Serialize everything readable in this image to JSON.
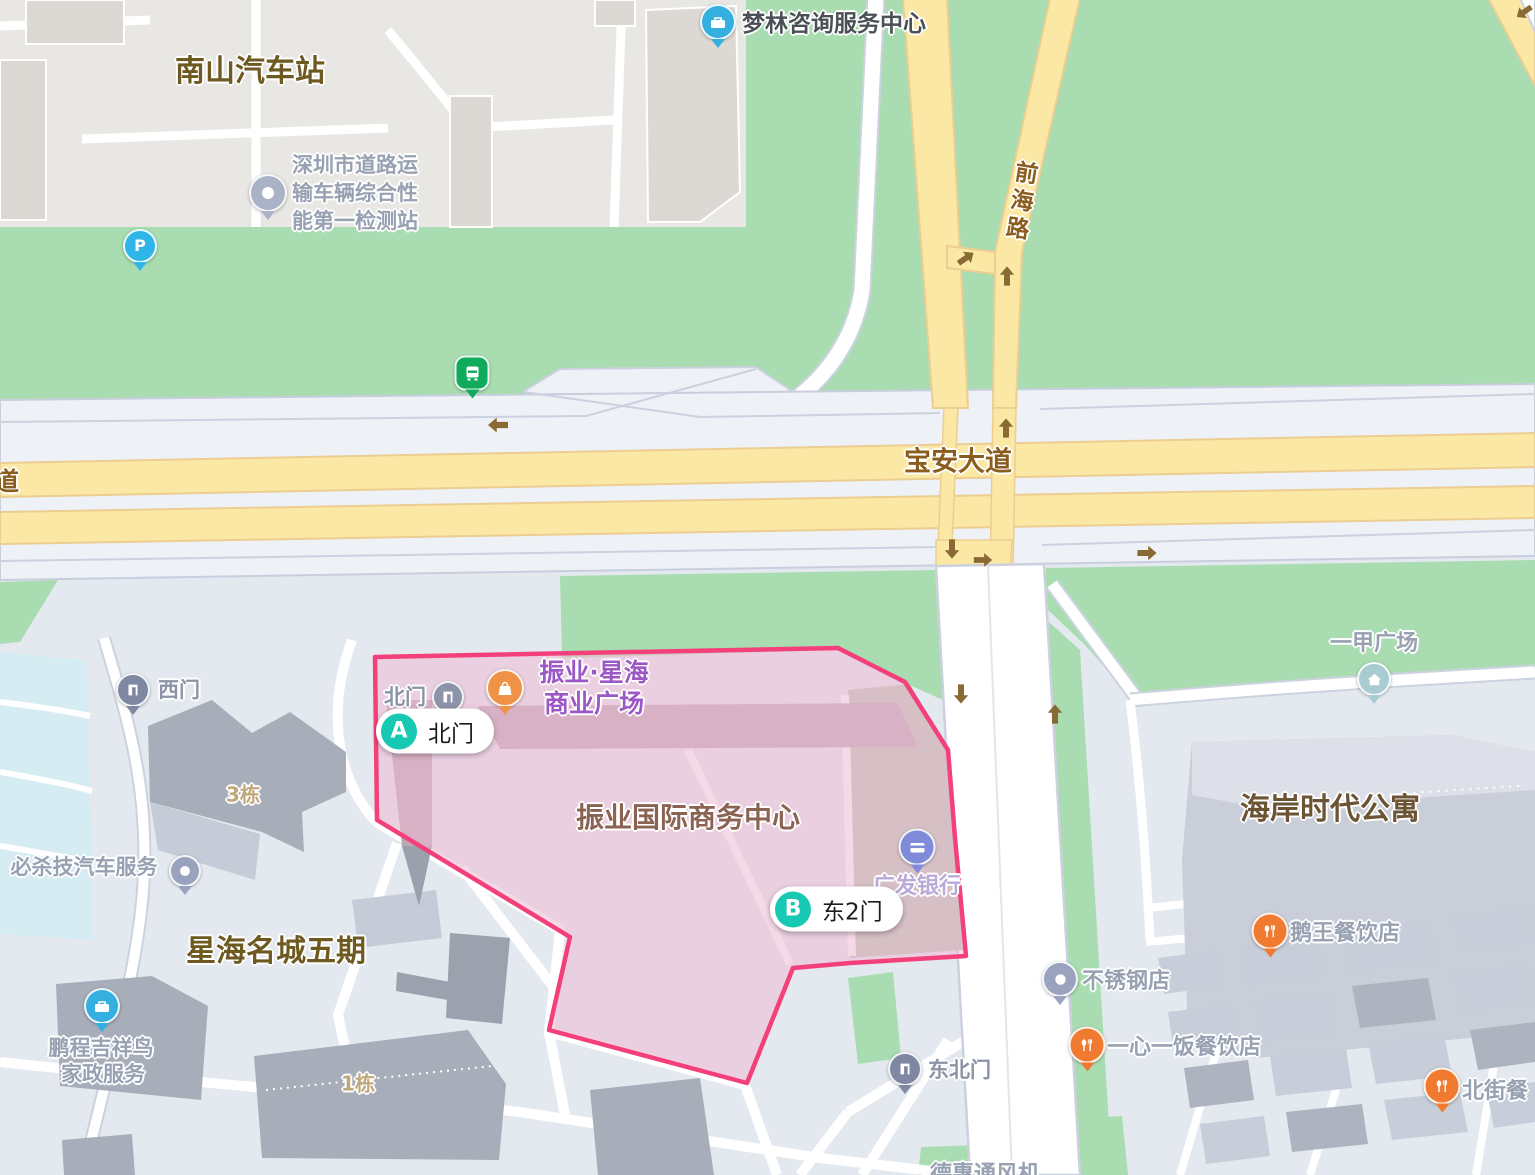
{
  "map": {
    "type": "street-map",
    "highlighted_area": {
      "name": "振业国际商务中心",
      "outline_color": "#f4407a",
      "fill_color": "#eebdd3"
    },
    "route_markers": {
      "a": {
        "letter": "A",
        "label": "北门"
      },
      "b": {
        "letter": "B",
        "label": "东2门"
      }
    },
    "roads": {
      "baoan_avenue": "宝安大道",
      "qianhai_road": "前海路",
      "edge_partial_road": "道"
    },
    "pois": {
      "nanshan_bus_station": "南山汽车站",
      "inspection_station_lines": [
        "深圳市道路运",
        "输车辆综合性",
        "能第一检测站"
      ],
      "menglin_consulting": "梦林咨询服务中心",
      "zhenye_xinghai_lines": [
        "振业·星海",
        "商业广场"
      ],
      "north_gate": "北门",
      "west_gate": "西门",
      "northeast_gate": "东北门",
      "cgb_bank": "广发银行",
      "bisha_auto_service": "必杀技汽车服务",
      "building_3": "3栋",
      "building_1": "1栋",
      "xinghai_mingcheng_phase5": "星海名城五期",
      "pengcheng_lines": [
        "鹏程吉祥鸟",
        "家政服务"
      ],
      "yijia_plaza": "一甲广场",
      "haian_times_apartment": "海岸时代公寓",
      "ewang_restaurant": "鹅王餐饮店",
      "stainless_steel_shop": "不锈钢店",
      "yixinyifan_restaurant": "一心一饭餐饮店",
      "beijie_restaurant_partial": "北街餐",
      "dehui_fan_partial": "德惠通风机"
    },
    "colors": {
      "vegetation": "#a9ddb1",
      "major_road": "#fbe8a4",
      "city_base": "#e4e9f0",
      "highlight_stroke": "#f4407a",
      "route_badge": "#17c8b3"
    }
  }
}
